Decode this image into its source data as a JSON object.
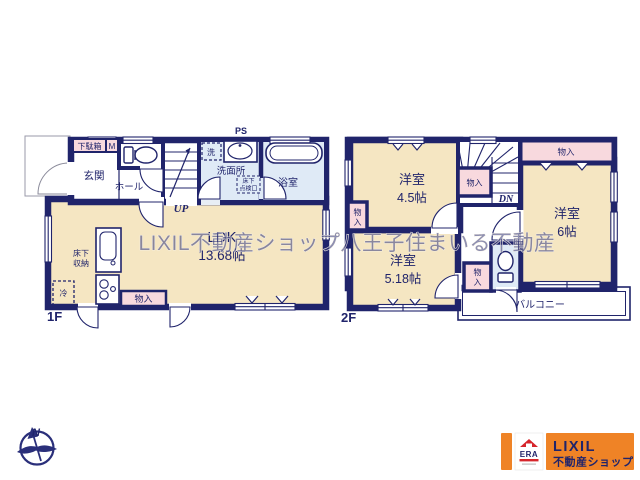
{
  "watermark": "LIXIL不動産ショップ八王子住まいる不動産",
  "floor1": {
    "label": "1F",
    "entrance": "玄関",
    "shoe_cabinet": "下駄箱",
    "meter": "M",
    "hall": "ホール",
    "ps": "PS",
    "laundry": "洗",
    "washroom": "洗面所",
    "hatch_line1": "床下",
    "hatch_line2": "点検口",
    "bath": "浴室",
    "stairs_up": "UP",
    "ldk_name": "LDK",
    "ldk_size": "13.68帖",
    "underfloor_line1": "床下",
    "underfloor_line2": "収納",
    "fridge": "冷",
    "closet": "物入"
  },
  "floor2": {
    "label": "2F",
    "room_a_name": "洋室",
    "room_a_size": "4.5帖",
    "room_b_name": "洋室",
    "room_b_size": "6帖",
    "room_c_name": "洋室",
    "room_c_size": "5.18帖",
    "closet": "物入",
    "closet_char1": "物",
    "closet_char2": "入",
    "stairs_down": "DN",
    "balcony": "バルコニー"
  },
  "compass": {
    "north": "N"
  },
  "logo": {
    "era": "ERA",
    "brand": "LIXIL",
    "brand_sub": "不動産ショップ"
  },
  "colors": {
    "wall_navy": "#20246b",
    "room_cream": "#f5e6c2",
    "wet_blue": "#dfeaf6",
    "closet_pink": "#f8d9de",
    "logo_orange": "#ef8326",
    "era_red": "#d6252b",
    "watermark_gray": "#8f8f8f"
  }
}
